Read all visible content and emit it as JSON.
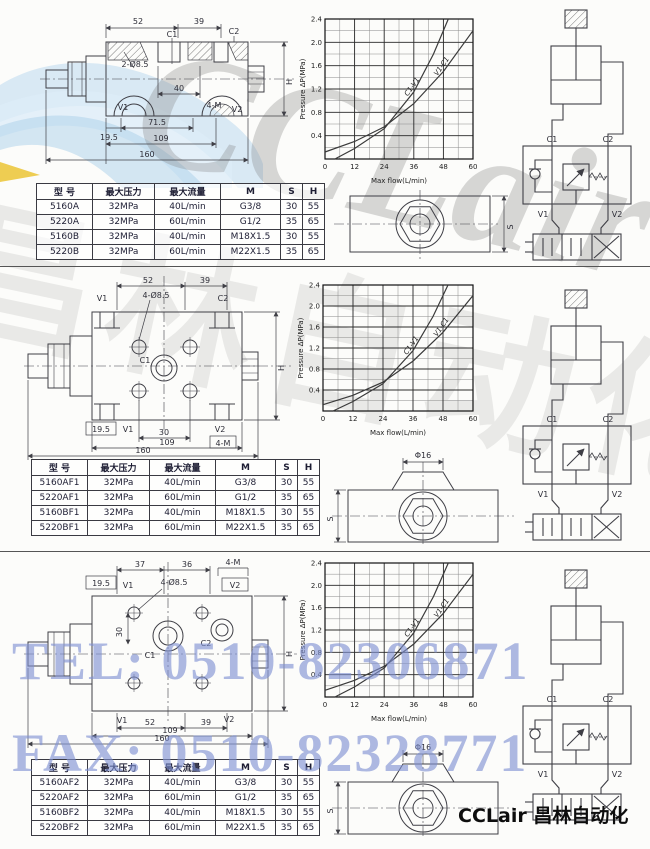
{
  "page": {
    "footer_brand": "CCLair 昌林自动化"
  },
  "watermarks": {
    "brand": "CCLair",
    "brand_cn": "昌林自动化",
    "tel": "TEL: 0510-82306871",
    "fax": "FAX: 0510-82328771",
    "accent_color": "#7e90d2"
  },
  "chart_data": [
    {
      "type": "line",
      "title": "",
      "xlabel": "Max flow(L/min)",
      "ylabel": "Pressure  ΔP(MPa)",
      "xlim": [
        0,
        60
      ],
      "ylim": [
        0,
        2.4
      ],
      "xminor": 6,
      "yminor": 0.2,
      "xticks": [
        0,
        12,
        24,
        36,
        48,
        60
      ],
      "xtick_labels": [
        "0",
        "12",
        "24",
        "36",
        "48",
        "60"
      ],
      "yticks": [
        0.4,
        0.8,
        1.2,
        1.6,
        2.0,
        2.4
      ],
      "ytick_labels": [
        "0.4",
        "0.8",
        "1.2",
        "1.6",
        "2.0",
        "2.4"
      ],
      "grid": true,
      "legend_position": "on-curve",
      "series": [
        {
          "name": "C1-V1",
          "x": [
            4,
            12,
            24,
            36,
            44,
            50
          ],
          "y": [
            0,
            0.18,
            0.52,
            1.15,
            1.8,
            2.4
          ],
          "label_at": 3
        },
        {
          "name": "V1-C1",
          "x": [
            0,
            12,
            24,
            36,
            48,
            60
          ],
          "y": [
            0.12,
            0.3,
            0.55,
            0.95,
            1.5,
            2.2
          ],
          "label_at": 4
        }
      ]
    },
    {
      "type": "line",
      "title": "",
      "xlabel": "Max flow(L/min)",
      "ylabel": "Pressure  ΔP(MPa)",
      "xlim": [
        0,
        60
      ],
      "ylim": [
        0,
        2.4
      ],
      "xminor": 6,
      "yminor": 0.2,
      "xticks": [
        0,
        12,
        24,
        36,
        48,
        60
      ],
      "xtick_labels": [
        "0",
        "12",
        "24",
        "36",
        "48",
        "60"
      ],
      "yticks": [
        0.4,
        0.8,
        1.2,
        1.6,
        2.0,
        2.4
      ],
      "ytick_labels": [
        "0.4",
        "0.8",
        "1.2",
        "1.6",
        "2.0",
        "2.4"
      ],
      "grid": true,
      "legend_position": "on-curve",
      "series": [
        {
          "name": "C1-V1",
          "x": [
            4,
            12,
            24,
            36,
            44,
            50
          ],
          "y": [
            0,
            0.18,
            0.52,
            1.15,
            1.8,
            2.4
          ],
          "label_at": 3
        },
        {
          "name": "V1-C1",
          "x": [
            0,
            12,
            24,
            36,
            48,
            60
          ],
          "y": [
            0.12,
            0.3,
            0.55,
            0.95,
            1.5,
            2.2
          ],
          "label_at": 4
        }
      ]
    },
    {
      "type": "line",
      "title": "",
      "xlabel": "Max flow(L/min)",
      "ylabel": "Pressure  ΔP(MPa)",
      "xlim": [
        0,
        60
      ],
      "ylim": [
        0,
        2.4
      ],
      "xminor": 6,
      "yminor": 0.2,
      "xticks": [
        0,
        12,
        24,
        36,
        48,
        60
      ],
      "xtick_labels": [
        "0",
        "12",
        "24",
        "36",
        "48",
        "60"
      ],
      "yticks": [
        0.4,
        0.8,
        1.2,
        1.6,
        2.0,
        2.4
      ],
      "ytick_labels": [
        "0.4",
        "0.8",
        "1.2",
        "1.6",
        "2.0",
        "2.4"
      ],
      "grid": true,
      "legend_position": "on-curve",
      "series": [
        {
          "name": "C1-V1",
          "x": [
            4,
            12,
            24,
            36,
            44,
            50
          ],
          "y": [
            0,
            0.18,
            0.52,
            1.15,
            1.8,
            2.4
          ],
          "label_at": 3
        },
        {
          "name": "V1-C1",
          "x": [
            0,
            12,
            24,
            36,
            48,
            60
          ],
          "y": [
            0.12,
            0.3,
            0.55,
            0.95,
            1.5,
            2.2
          ],
          "label_at": 4
        }
      ]
    }
  ],
  "sections": [
    {
      "table": {
        "headers": [
          "型 号",
          "最大压力",
          "最大流量",
          "M",
          "S",
          "H"
        ],
        "rows": [
          [
            "5160A",
            "32MPa",
            "40L/min",
            "G3/8",
            "30",
            "55"
          ],
          [
            "5220A",
            "32MPa",
            "60L/min",
            "G1/2",
            "35",
            "65"
          ],
          [
            "5160B",
            "32MPa",
            "40L/min",
            "M18X1.5",
            "30",
            "55"
          ],
          [
            "5220B",
            "32MPa",
            "60L/min",
            "M22X1.5",
            "35",
            "65"
          ]
        ]
      },
      "drawing": {
        "d52": "52",
        "d39": "39",
        "c1": "C1",
        "c2": "C2",
        "holes": "2-Ø8.5",
        "d40": "40",
        "v1": "V1",
        "m4": "4-M",
        "v2": "V2",
        "d195": "19.5",
        "d715": "71.5",
        "d109": "109",
        "d160": "160",
        "h": "H"
      },
      "hex": {
        "s": "S"
      },
      "circuit": {
        "c1": "C1",
        "c2": "C2",
        "v1": "V1",
        "v2": "V2"
      }
    },
    {
      "table": {
        "headers": [
          "型 号",
          "最大压力",
          "最大流量",
          "M",
          "S",
          "H"
        ],
        "rows": [
          [
            "5160AF1",
            "32MPa",
            "40L/min",
            "G3/8",
            "30",
            "55"
          ],
          [
            "5220AF1",
            "32MPa",
            "60L/min",
            "G1/2",
            "35",
            "65"
          ],
          [
            "5160BF1",
            "32MPa",
            "40L/min",
            "M18X1.5",
            "30",
            "55"
          ],
          [
            "5220BF1",
            "32MPa",
            "60L/min",
            "M22X1.5",
            "35",
            "65"
          ]
        ]
      },
      "drawing": {
        "d52": "52",
        "d39": "39",
        "v1t": "V1",
        "holes": "4-Ø8.5",
        "c2": "C2",
        "c1": "C1",
        "d195": "19.5",
        "v1b": "V1",
        "d30": "30",
        "v2": "V2",
        "m4": "4-M",
        "d109": "109",
        "d160": "160",
        "h": "H"
      },
      "hex": {
        "s": "S",
        "dia": "Φ16"
      },
      "circuit": {
        "c1": "C1",
        "c2": "C2",
        "v1": "V1",
        "v2": "V2"
      }
    },
    {
      "table": {
        "headers": [
          "型 号",
          "最大压力",
          "最大流量",
          "M",
          "S",
          "H"
        ],
        "rows": [
          [
            "5160AF2",
            "32MPa",
            "40L/min",
            "G3/8",
            "30",
            "55"
          ],
          [
            "5220AF2",
            "32MPa",
            "60L/min",
            "G1/2",
            "35",
            "65"
          ],
          [
            "5160BF2",
            "32MPa",
            "40L/min",
            "M18X1.5",
            "30",
            "55"
          ],
          [
            "5220BF2",
            "32MPa",
            "60L/min",
            "M22X1.5",
            "35",
            "65"
          ]
        ]
      },
      "drawing": {
        "d37": "37",
        "d36": "36",
        "m4": "4-M",
        "d195": "19.5",
        "v1t": "V1",
        "holes": "4-Ø8.5",
        "v2t": "V2",
        "c1": "C1",
        "c2": "C2",
        "d30": "30",
        "v1b": "V1",
        "v2b": "V2",
        "d52": "52",
        "d39": "39",
        "d109": "109",
        "d160": "160",
        "h": "H"
      },
      "hex": {
        "s": "S",
        "dia": "Φ16"
      },
      "circuit": {
        "c1": "C1",
        "c2": "C2",
        "v1": "V1",
        "v2": "V2"
      }
    }
  ]
}
